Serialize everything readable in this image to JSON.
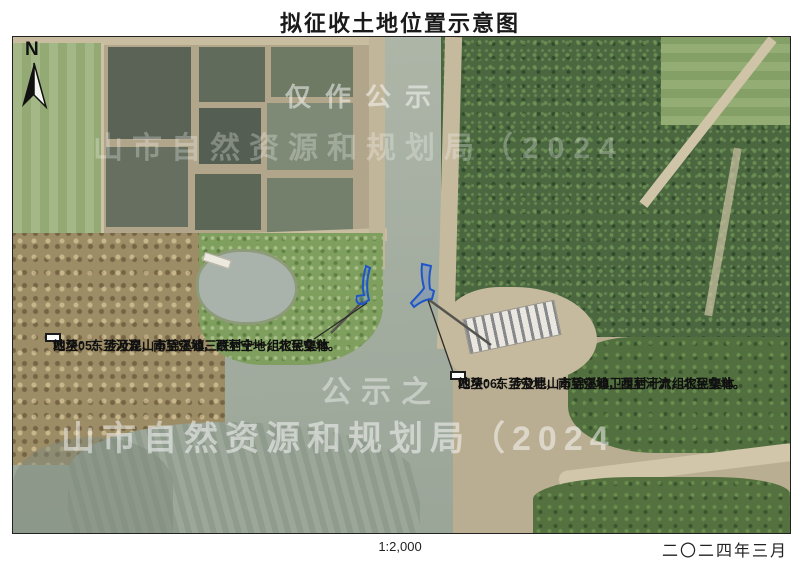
{
  "page": {
    "title": "拟征收土地位置示意图",
    "scale": "1:2,000",
    "date": "二〇二四年三月"
  },
  "map": {
    "north_label": "N",
    "parcel_outline_color": "#1e55c8",
    "annotations": [
      {
        "id": "05",
        "line1": "地块05：涉及昆山市锦溪镇三联村十一组农民集体",
        "line2": "四至：东至河流，南至空地，西至空地，北至空地。"
      },
      {
        "id": "06",
        "line1": "地块06：涉及昆山市锦溪镇卫星村十六组农民集体",
        "line2": "四至：东至空地，南至空地，西至河流，北至空地。"
      }
    ],
    "watermarks": [
      {
        "text": "仅作公示"
      },
      {
        "text": "山市自然资源和规划局（2024"
      },
      {
        "text": "公示之"
      },
      {
        "text": "山市自然资源和规划局（2024"
      }
    ]
  }
}
